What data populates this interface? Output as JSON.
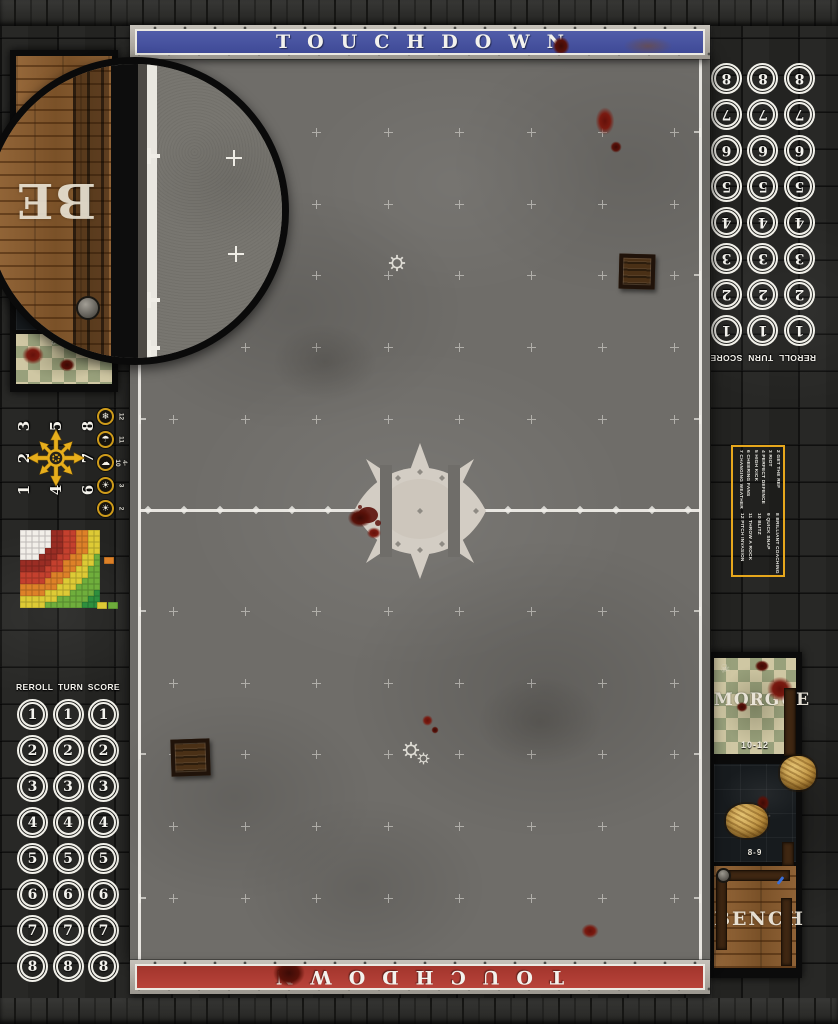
{
  "title": "Blood Bowl street pitch game mat",
  "banners": {
    "top_label": "TOUCHDOWN",
    "bottom_label": "TOUCHDOWN"
  },
  "tracker": {
    "headers": [
      "REROLL",
      "TURN",
      "SCORE"
    ],
    "numbers": [
      1,
      2,
      3,
      4,
      5,
      6,
      7,
      8
    ],
    "columns": 3
  },
  "left_dugout": {
    "bench_label": "BENCH",
    "morgue_range": "10-12"
  },
  "right_dugout": {
    "morgue_label": "MORGUE",
    "morgue_range": "10-12",
    "ko_label": "K.O.",
    "ko_range": "8-9",
    "bench_label": "BENCH"
  },
  "magnifier": {
    "visible_text": "BE"
  },
  "scatter_template": {
    "numbers": [
      1,
      2,
      3,
      4,
      null,
      5,
      6,
      7,
      8
    ]
  },
  "weather_table": [
    {
      "roll": "12",
      "icon": "snow-cloud-icon"
    },
    {
      "roll": "11",
      "icon": "rain-cloud-icon"
    },
    {
      "roll": "4-10",
      "icon": "sun-cloud-icon"
    },
    {
      "roll": "3",
      "icon": "sun-icon"
    },
    {
      "roll": "2",
      "icon": "sun-icon"
    }
  ],
  "kickoff_table": {
    "column_1": [
      "2 GET THE REF",
      "3 RIOT",
      "4 PERFECT DEFENCE",
      "5 HIGH KICK",
      "6 CHEERING FANS",
      "7 CHANGING WEATHER"
    ],
    "column_2": [
      "8 BRILLIANT COACHING",
      "9 QUICK SNAP",
      "10 BLITZ",
      "11 THROW A ROCK",
      "12 PITCH INVASION"
    ]
  },
  "range_ruler": {
    "colors": {
      "white": "#f2efe9",
      "dark_red": "#9a2d24",
      "red": "#c4402e",
      "orange": "#dd8128",
      "yellow": "#ddca35",
      "green": "#6fae3c",
      "deep_green": "#2e8f3e"
    }
  },
  "icons": {
    "field_marker": "gear-icon",
    "morgue_marker": "skull-icon"
  },
  "colors": {
    "banner_blue": "#4a55a8",
    "banner_red": "#b23b31",
    "pitch_gray": "#6f6d69",
    "wall_dark": "#232321",
    "template_yellow": "#e7a71c",
    "white_line": "#efeee9",
    "blood_red": "#6e140c"
  }
}
